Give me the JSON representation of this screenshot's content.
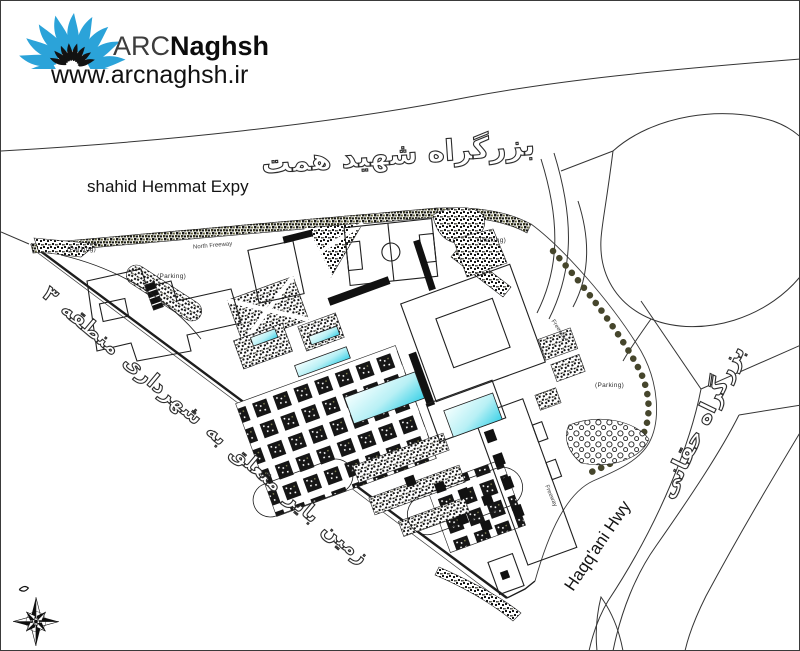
{
  "logo": {
    "brand_prefix": "ARC",
    "brand_suffix": "Naghsh",
    "website": "www.arcnaghsh.ir"
  },
  "labels": {
    "hemmat_expressway_fa": "بزرگراه شهید همت",
    "hemmat_expressway_en": "shahid Hemmat Expy",
    "haqqani_highway_fa": "بزرگراه حقانی",
    "haqqani_highway_en": "Haqq'ani Hwy",
    "vacant_land_fa": "زمین بایر متعلق به شهرداری منطقه ۳",
    "parking": "(Parking)",
    "freeway_top": "North Freeway",
    "freeway_right_ramp": "Freeway",
    "freeway_bottom_ramp": "Freeway"
  },
  "icons": {
    "logo_sunburst": "sunburst-fan-icon",
    "compass": "compass-rose-icon"
  },
  "colors": {
    "brand_blue": "#2BA3D9",
    "pool_cyan": "#52D7EA",
    "tree_olive": "#6E6E49",
    "ink": "#2B2B2B"
  }
}
